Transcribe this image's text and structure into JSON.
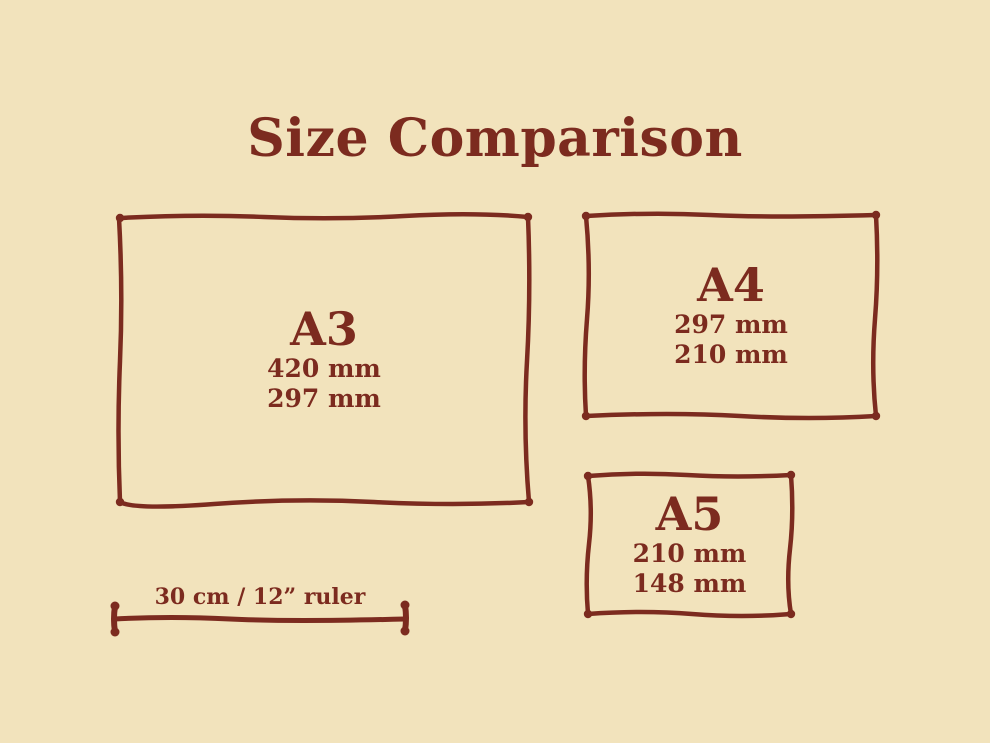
{
  "title": "Size Comparison",
  "colors": {
    "background": "#F2E3BC",
    "ink": "#7C2B1F"
  },
  "papers": [
    {
      "id": "a3",
      "name": "A3",
      "width_label": "420 mm",
      "height_label": "297 mm"
    },
    {
      "id": "a4",
      "name": "A4",
      "width_label": "297 mm",
      "height_label": "210 mm"
    },
    {
      "id": "a5",
      "name": "A5",
      "width_label": "210 mm",
      "height_label": "148 mm"
    }
  ],
  "ruler": {
    "label": "30 cm / 12” ruler"
  }
}
